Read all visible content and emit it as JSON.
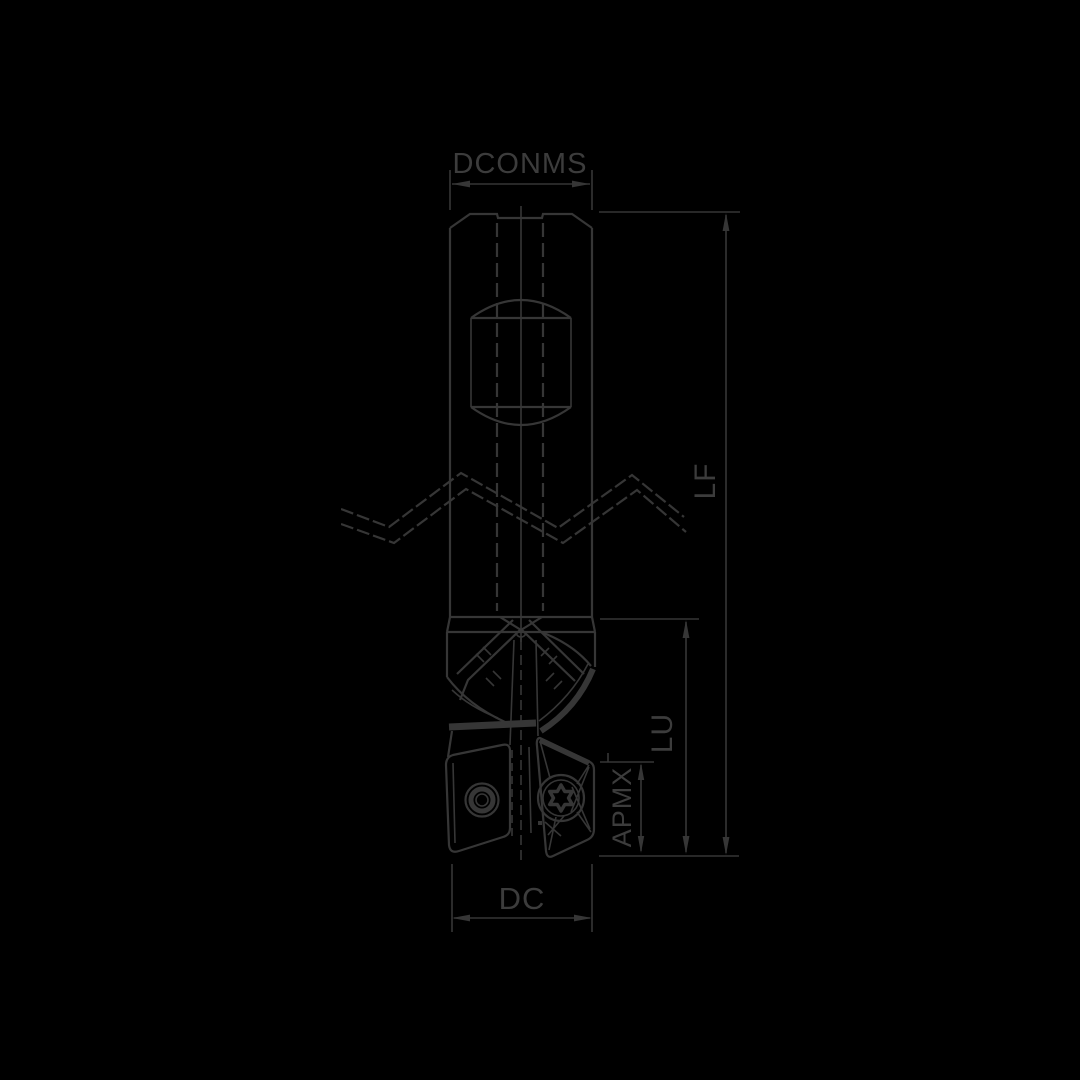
{
  "colors": {
    "background": "#000000",
    "line": "#363636",
    "text": "#3c3c3c"
  },
  "drawing": {
    "type": "technical-dimension-drawing",
    "subject": "Indexable square-shoulder end mill with cylindrical shank, side view, shown with break lines and insert screws",
    "labels": {
      "shank_diameter": "DCONMS",
      "functional_length": "LF",
      "usable_length": "LU",
      "max_depth_of_cut": "APMX",
      "cutting_diameter": "DC"
    }
  }
}
